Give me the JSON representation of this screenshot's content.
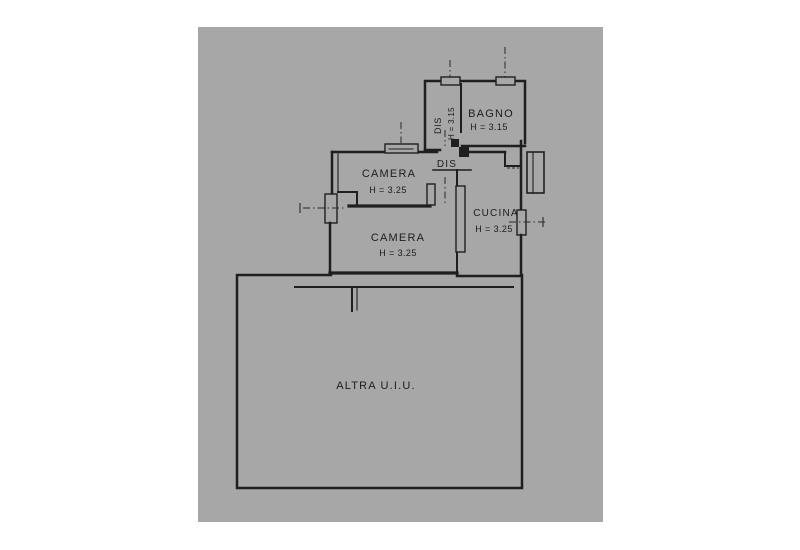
{
  "page": {
    "background_color": "#ffffff",
    "paper_color": "#a7a7a7",
    "ink_color": "#1f1f1f"
  },
  "floor_plan": {
    "rooms": [
      {
        "id": "bagno",
        "name": "BAGNO",
        "height": "H = 3.15"
      },
      {
        "id": "dis-closet",
        "name": "DIS",
        "height": "H = 3.15"
      },
      {
        "id": "camera-top",
        "name": "CAMERA",
        "height": "H = 3.25"
      },
      {
        "id": "dis-hall",
        "name": "DIS",
        "height": ""
      },
      {
        "id": "cucina",
        "name": "CUCINA",
        "height": "H = 3.25"
      },
      {
        "id": "camera-main",
        "name": "CAMERA",
        "height": "H = 3.25"
      },
      {
        "id": "altra-uiu",
        "name": "ALTRA U.I.U.",
        "height": ""
      }
    ]
  }
}
